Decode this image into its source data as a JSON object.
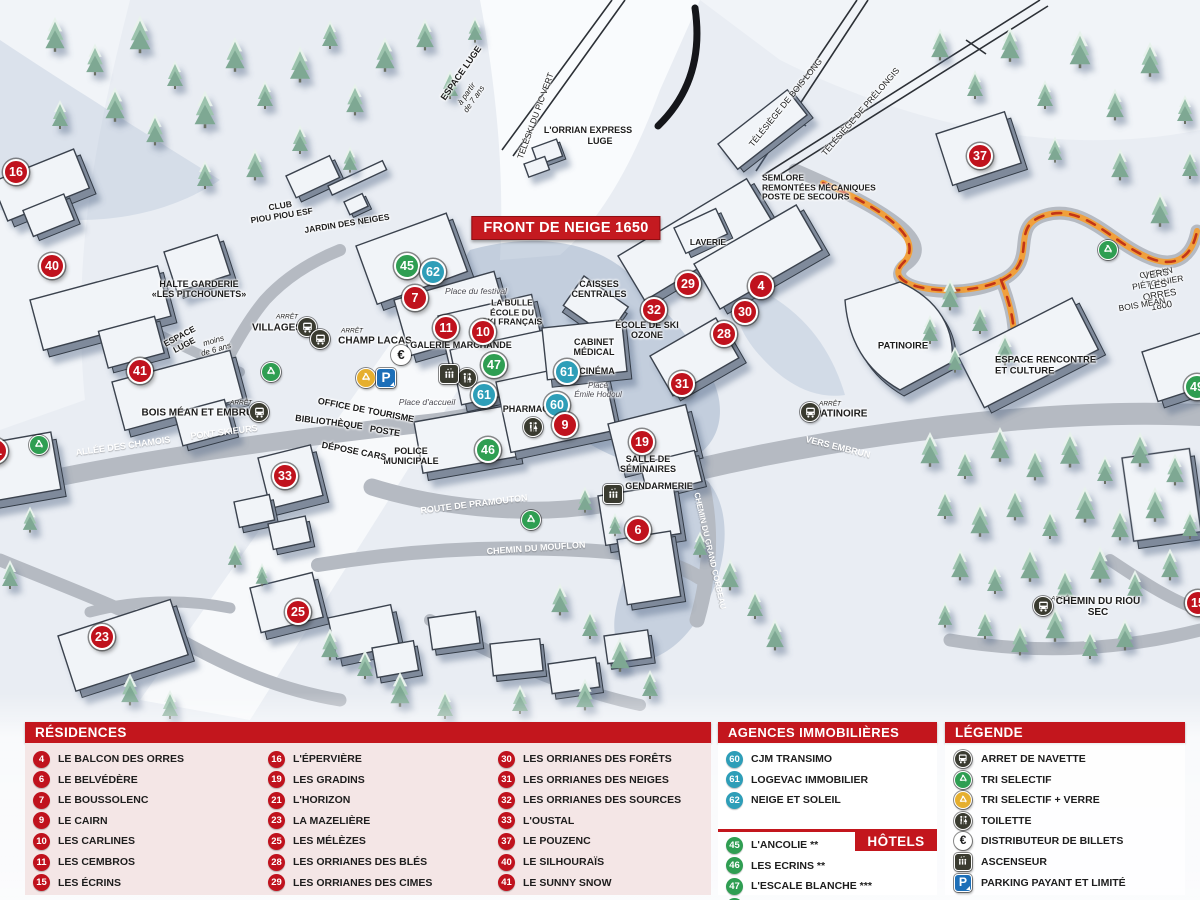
{
  "colors": {
    "header_red": "#c3161d",
    "marker_red": "#c0121d",
    "marker_blue": "#2e9eb8",
    "marker_green": "#2f9e52",
    "panel_pink": "#f4e6e6",
    "parking_blue": "#1d6fb8",
    "recycle_yellow": "#e6af2e",
    "dark_icon": "#3a3b30"
  },
  "map": {
    "banner": "FRONT DE NEIGE 1650",
    "markers": [
      {
        "n": "16",
        "c": "red",
        "x": 16,
        "y": 172
      },
      {
        "n": "40",
        "c": "red",
        "x": 52,
        "y": 266
      },
      {
        "n": "41",
        "c": "red",
        "x": 140,
        "y": 371
      },
      {
        "n": "21",
        "c": "red",
        "x": -5,
        "y": 451
      },
      {
        "n": "33",
        "c": "red",
        "x": 285,
        "y": 476
      },
      {
        "n": "23",
        "c": "red",
        "x": 102,
        "y": 637
      },
      {
        "n": "25",
        "c": "red",
        "x": 298,
        "y": 612
      },
      {
        "n": "7",
        "c": "red",
        "x": 415,
        "y": 298
      },
      {
        "n": "45",
        "c": "green",
        "x": 407,
        "y": 266
      },
      {
        "n": "62",
        "c": "blue",
        "x": 433,
        "y": 272
      },
      {
        "n": "11",
        "c": "red",
        "x": 446,
        "y": 328
      },
      {
        "n": "10",
        "c": "red",
        "x": 483,
        "y": 332
      },
      {
        "n": "47",
        "c": "green",
        "x": 494,
        "y": 365
      },
      {
        "n": "61",
        "c": "blue",
        "x": 484,
        "y": 395
      },
      {
        "n": "61",
        "c": "blue",
        "x": 567,
        "y": 372
      },
      {
        "n": "60",
        "c": "blue",
        "x": 557,
        "y": 405
      },
      {
        "n": "9",
        "c": "red",
        "x": 565,
        "y": 425
      },
      {
        "n": "46",
        "c": "green",
        "x": 488,
        "y": 450
      },
      {
        "n": "19",
        "c": "red",
        "x": 642,
        "y": 442
      },
      {
        "n": "6",
        "c": "red",
        "x": 638,
        "y": 530
      },
      {
        "n": "29",
        "c": "red",
        "x": 688,
        "y": 284
      },
      {
        "n": "32",
        "c": "red",
        "x": 654,
        "y": 310
      },
      {
        "n": "4",
        "c": "red",
        "x": 761,
        "y": 286
      },
      {
        "n": "30",
        "c": "red",
        "x": 745,
        "y": 312
      },
      {
        "n": "28",
        "c": "red",
        "x": 724,
        "y": 334
      },
      {
        "n": "31",
        "c": "red",
        "x": 682,
        "y": 384
      },
      {
        "n": "37",
        "c": "red",
        "x": 980,
        "y": 156
      },
      {
        "n": "49",
        "c": "green",
        "x": 1197,
        "y": 387
      },
      {
        "n": "15",
        "c": "red",
        "x": 1198,
        "y": 603
      }
    ],
    "labels": [
      {
        "t": "ESPACE LUGE",
        "x": 461,
        "y": 73,
        "rot": -55,
        "fs": 9,
        "b": 1
      },
      {
        "t": "à partir\nde 7 ans",
        "x": 471,
        "y": 97,
        "rot": -55,
        "fs": 8,
        "i": 1
      },
      {
        "t": "TÉLÉSKI DU PIC VERT",
        "x": 536,
        "y": 116,
        "rot": -70,
        "fs": 8.5
      },
      {
        "t": "L'ORRIAN EXPRESS",
        "x": 588,
        "y": 130,
        "fs": 9,
        "b": 1
      },
      {
        "t": "LUGE",
        "x": 600,
        "y": 141,
        "fs": 9,
        "b": 1
      },
      {
        "t": "TÉLÉSIÈGE DE BOIS LONG",
        "x": 786,
        "y": 103,
        "rot": -51,
        "fs": 8.5
      },
      {
        "t": "TÉLÉSIÈGE DE PRÉLONGIS",
        "x": 861,
        "y": 112,
        "rot": -49,
        "fs": 8.5
      },
      {
        "t": "SEMLORE\nREMONTÉES MÉCANIQUES\nPOSTE DE SECOURS",
        "x": 762,
        "y": 188,
        "fs": 8.5,
        "b": 1,
        "align": "left"
      },
      {
        "t": "CLUB\nPIOU PIOU ESF",
        "x": 281,
        "y": 211,
        "rot": -9,
        "fs": 8.5,
        "b": 1
      },
      {
        "t": "JARDIN DES NEIGES",
        "x": 347,
        "y": 224,
        "rot": -9,
        "fs": 8.5,
        "b": 1
      },
      {
        "t": "HALTE GARDERIE\n«LES PITCHOUNETS»",
        "x": 199,
        "y": 289,
        "fs": 9,
        "b": 1
      },
      {
        "t": "ESPACE\nLUGE",
        "x": 182,
        "y": 341,
        "rot": -28,
        "fs": 8.5,
        "b": 1
      },
      {
        "t": "moins\nde 6 ans",
        "x": 215,
        "y": 346,
        "rot": -16,
        "fs": 8,
        "i": 1
      },
      {
        "t": "ARRÊT",
        "x": 287,
        "y": 317,
        "fs": 6.5,
        "i": 1
      },
      {
        "t": "VILLAGES",
        "x": 277,
        "y": 328,
        "fs": 10,
        "b": 1
      },
      {
        "t": "ARRÊT",
        "x": 352,
        "y": 331,
        "fs": 6.5,
        "i": 1
      },
      {
        "t": "CHAMP LACAS",
        "x": 375,
        "y": 341,
        "fs": 10,
        "b": 1
      },
      {
        "t": "GALERIE MARCHANDE",
        "x": 461,
        "y": 345,
        "fs": 9,
        "b": 1
      },
      {
        "t": "LA BULLE\nÉCOLE DU\nSKI FRANÇAIS",
        "x": 512,
        "y": 313,
        "fs": 8.5,
        "b": 1
      },
      {
        "t": "Place du festival",
        "x": 476,
        "y": 292,
        "fs": 8.5,
        "i": 1,
        "col": "#4a4a52"
      },
      {
        "t": "CAISSES\nCENTRALES",
        "x": 599,
        "y": 289,
        "fs": 9,
        "b": 1
      },
      {
        "t": "CABINET\nMÉDICAL",
        "x": 594,
        "y": 347,
        "fs": 9,
        "b": 1
      },
      {
        "t": "CINÉMA",
        "x": 597,
        "y": 371,
        "fs": 9,
        "b": 1
      },
      {
        "t": "Place\nÉmile Hodoul",
        "x": 598,
        "y": 391,
        "fs": 8,
        "i": 1,
        "col": "#4a4a52"
      },
      {
        "t": "PHARMACIE",
        "x": 530,
        "y": 409,
        "fs": 9,
        "b": 1
      },
      {
        "t": "ÉCOLE DE SKI\nOZONE",
        "x": 647,
        "y": 330,
        "fs": 9,
        "b": 1
      },
      {
        "t": "LAVERIE",
        "x": 708,
        "y": 243,
        "fs": 8.5,
        "b": 1
      },
      {
        "t": "PATINOIRE",
        "x": 903,
        "y": 347,
        "fs": 9.5,
        "b": 1
      },
      {
        "t": "ARRÊT",
        "x": 830,
        "y": 404,
        "fs": 6.5,
        "i": 1
      },
      {
        "t": "PATINOIRE",
        "x": 841,
        "y": 414,
        "fs": 10,
        "b": 1
      },
      {
        "t": "VERS EMBRUN",
        "x": 838,
        "y": 447,
        "rot": 14,
        "fs": 9,
        "b": 1,
        "col": "#fff"
      },
      {
        "t": "CHEMIN DU GRAND CORBEAU",
        "x": 709,
        "y": 551,
        "rot": 77,
        "fs": 8,
        "b": 1,
        "col": "#fff"
      },
      {
        "t": "SALLE DE\nSÉMINAIRES",
        "x": 648,
        "y": 464,
        "fs": 9,
        "b": 1
      },
      {
        "t": "GENDARMERIE",
        "x": 659,
        "y": 486,
        "fs": 9,
        "b": 1
      },
      {
        "t": "ROUTE DE PRAMOUTON",
        "x": 474,
        "y": 504,
        "rot": -7,
        "fs": 9,
        "b": 1,
        "col": "#fff"
      },
      {
        "t": "CHEMIN DU MOUFLON",
        "x": 536,
        "y": 548,
        "rot": -4,
        "fs": 9,
        "b": 1,
        "col": "#fff"
      },
      {
        "t": "POLICE\nMUNICIPALE",
        "x": 411,
        "y": 456,
        "fs": 9,
        "b": 1
      },
      {
        "t": "OFFICE DE TOURISME",
        "x": 366,
        "y": 410,
        "rot": 11,
        "fs": 9,
        "b": 1
      },
      {
        "t": "BIBLIOTHÈQUE",
        "x": 329,
        "y": 422,
        "rot": 7,
        "fs": 9,
        "b": 1
      },
      {
        "t": "POSTE",
        "x": 385,
        "y": 431,
        "rot": 9,
        "fs": 9,
        "b": 1
      },
      {
        "t": "DÉPOSE CARS",
        "x": 354,
        "y": 451,
        "rot": 11,
        "fs": 9,
        "b": 1
      },
      {
        "t": "PONT SKIEURS",
        "x": 224,
        "y": 432,
        "rot": -7,
        "fs": 9,
        "b": 1,
        "col": "#fff"
      },
      {
        "t": "ALLÉE DES CHAMOIS",
        "x": 123,
        "y": 446,
        "rot": -8,
        "fs": 9,
        "b": 1,
        "col": "#fff"
      },
      {
        "t": "ARRÊT",
        "x": 241,
        "y": 403,
        "fs": 6.5,
        "i": 1
      },
      {
        "t": "BOIS MÉAN ET EMBRUN",
        "x": 201,
        "y": 413,
        "fs": 10,
        "b": 1
      },
      {
        "t": "ARRÊT",
        "x": 1062,
        "y": 599,
        "fs": 6.5,
        "i": 1
      },
      {
        "t": "CHEMIN DU RIOU SEC",
        "x": 1098,
        "y": 607,
        "fs": 10,
        "b": 1
      },
      {
        "t": "CHEMIN PIÉTONNIER",
        "x": 1157,
        "y": 278,
        "rot": -10,
        "fs": 8.5
      },
      {
        "t": "VERS LES ORRES 1800",
        "x": 1159,
        "y": 291,
        "rot": -10,
        "fs": 9.5
      },
      {
        "t": "BOIS MÉAN",
        "x": 1142,
        "y": 305,
        "rot": -10,
        "fs": 8.5
      },
      {
        "t": "ESPACE RENCONTRE\nET CULTURE",
        "x": 995,
        "y": 366,
        "fs": 9.5,
        "b": 1,
        "align": "left"
      },
      {
        "t": "Place d'accueil",
        "x": 427,
        "y": 403,
        "fs": 8.5,
        "i": 1,
        "col": "#4a4a52"
      }
    ],
    "icons": [
      {
        "t": "bus",
        "x": 307,
        "y": 327
      },
      {
        "t": "bus",
        "x": 320,
        "y": 339
      },
      {
        "t": "bus",
        "x": 259,
        "y": 412
      },
      {
        "t": "bus",
        "x": 810,
        "y": 412
      },
      {
        "t": "bus",
        "x": 1043,
        "y": 606
      },
      {
        "t": "recycle-green",
        "x": 271,
        "y": 372
      },
      {
        "t": "recycle-green",
        "x": 39,
        "y": 445
      },
      {
        "t": "recycle-green",
        "x": 531,
        "y": 520
      },
      {
        "t": "recycle-green",
        "x": 1108,
        "y": 250
      },
      {
        "t": "recycle-yellow",
        "x": 366,
        "y": 378
      },
      {
        "t": "parking",
        "x": 386,
        "y": 378
      },
      {
        "t": "euro",
        "x": 401,
        "y": 355
      },
      {
        "t": "toilet",
        "x": 467,
        "y": 378
      },
      {
        "t": "toilet",
        "x": 533,
        "y": 427
      },
      {
        "t": "elevator",
        "x": 449,
        "y": 374
      },
      {
        "t": "elevator",
        "x": 613,
        "y": 494
      }
    ]
  },
  "panels": {
    "residences": {
      "header": "RÉSIDENCES",
      "columns": [
        [
          {
            "num": "4",
            "name": "LE BALCON DES ORRES"
          },
          {
            "num": "6",
            "name": "LE BELVÉDÈRE"
          },
          {
            "num": "7",
            "name": "LE BOUSSOLENC"
          },
          {
            "num": "9",
            "name": "LE CAIRN"
          },
          {
            "num": "10",
            "name": "LES CARLINES"
          },
          {
            "num": "11",
            "name": "LES CEMBROS"
          },
          {
            "num": "15",
            "name": "LES ÉCRINS"
          }
        ],
        [
          {
            "num": "16",
            "name": "L'ÉPERVIÈRE"
          },
          {
            "num": "19",
            "name": "LES GRADINS"
          },
          {
            "num": "21",
            "name": "L'HORIZON"
          },
          {
            "num": "23",
            "name": "LA MAZELIÈRE"
          },
          {
            "num": "25",
            "name": "LES MÉLÈZES"
          },
          {
            "num": "28",
            "name": "LES ORRIANES DES BLÉS"
          },
          {
            "num": "29",
            "name": "LES ORRIANES DES CIMES"
          }
        ],
        [
          {
            "num": "30",
            "name": "LES ORRIANES DES FORÊTS"
          },
          {
            "num": "31",
            "name": "LES ORRIANES DES NEIGES"
          },
          {
            "num": "32",
            "name": "LES ORRIANES DES SOURCES"
          },
          {
            "num": "33",
            "name": "L'OUSTAL"
          },
          {
            "num": "37",
            "name": "LE POUZENC"
          },
          {
            "num": "40",
            "name": "LE SILHOURAÏS"
          },
          {
            "num": "41",
            "name": "LE SUNNY SNOW"
          }
        ]
      ]
    },
    "agences": {
      "header": "AGENCES IMMOBILIÈRES",
      "items": [
        {
          "num": "60",
          "name": "CJM TRANSIMO"
        },
        {
          "num": "61",
          "name": "LOGEVAC IMMOBILIER"
        },
        {
          "num": "62",
          "name": "NEIGE ET SOLEIL"
        }
      ]
    },
    "hotels": {
      "header": "HÔTELS",
      "items": [
        {
          "num": "45",
          "name": "L'ANCOLIE **"
        },
        {
          "num": "46",
          "name": "LES ECRINS **"
        },
        {
          "num": "47",
          "name": "L'ESCALE BLANCHE ***"
        },
        {
          "num": "49",
          "name": "LES TRAPPEURS **"
        }
      ]
    },
    "legende": {
      "header": "LÉGENDE",
      "items": [
        {
          "icon": "bus",
          "label": "ARRET DE NAVETTE"
        },
        {
          "icon": "recycle-green",
          "label": "TRI SELECTIF"
        },
        {
          "icon": "recycle-yellow",
          "label": "TRI SELECTIF + VERRE"
        },
        {
          "icon": "toilet",
          "label": "TOILETTE"
        },
        {
          "icon": "euro",
          "label": "DISTRIBUTEUR DE BILLETS"
        },
        {
          "icon": "elevator",
          "label": "ASCENSEUR"
        },
        {
          "icon": "parking",
          "label": "PARKING PAYANT ET LIMITÉ"
        }
      ]
    }
  }
}
